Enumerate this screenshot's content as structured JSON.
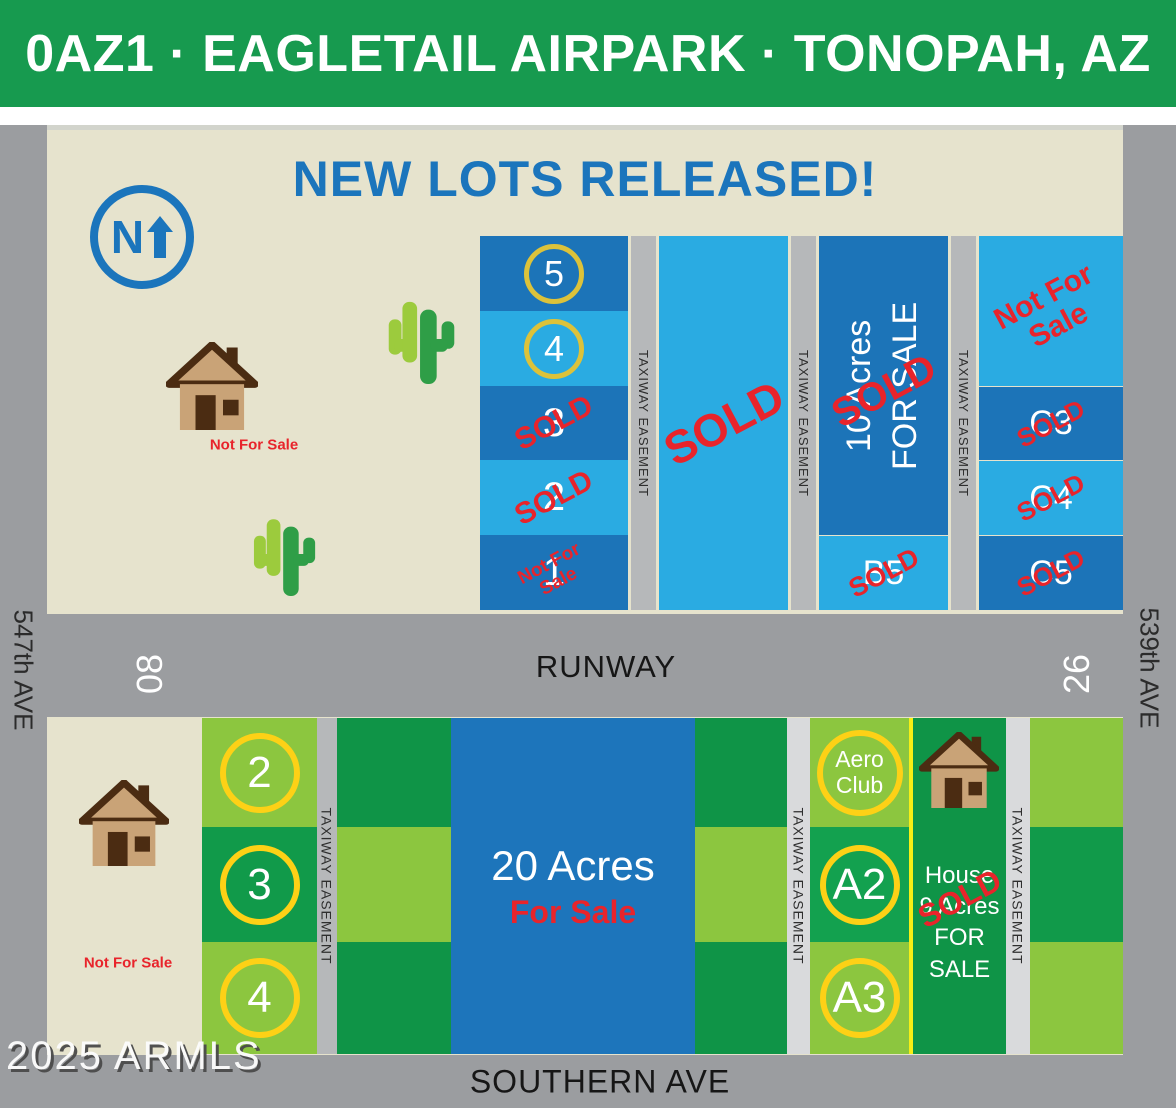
{
  "header": {
    "title": "0AZ1 · EAGLETAIL AIRPARK · TONOPAH, AZ"
  },
  "map": {
    "banner": "NEW LOTS RELEASED!",
    "compass": "N",
    "streets": {
      "left": "547th AVE",
      "right": "539th AVE",
      "bottom": "SOUTHERN AVE"
    },
    "runway": {
      "label": "RUNWAY",
      "west_number": "08",
      "east_number": "26"
    },
    "taxiway_label": "TAXIWAY EASEMENT",
    "stamps": {
      "sold": "SOLD",
      "not_for": "Not For",
      "sale": "Sale"
    },
    "houses": {
      "north_label": "Not For Sale",
      "southwest_label": "Not For Sale"
    },
    "north_lots": {
      "numbered": [
        {
          "label": "5"
        },
        {
          "label": "4"
        },
        {
          "label": "3"
        },
        {
          "label": "2"
        },
        {
          "label": "1"
        }
      ],
      "ten_acres": {
        "line1": "10 Acres",
        "line2": "FOR SALE"
      },
      "b5": {
        "label": "B5"
      },
      "c_block": {
        "lots": [
          {
            "label": "C3"
          },
          {
            "label": "C4"
          },
          {
            "label": "C5"
          }
        ]
      }
    },
    "south_lots": {
      "numbered": [
        {
          "label": "2"
        },
        {
          "label": "3"
        },
        {
          "label": "4"
        }
      ],
      "twenty_acres": {
        "line1": "20 Acres",
        "line2": "For Sale"
      },
      "aero_club": {
        "line1": "Aero",
        "line2": "Club"
      },
      "a_lots": [
        {
          "label": "A2"
        },
        {
          "label": "A3"
        }
      ],
      "house_lot": {
        "line1": "House",
        "line2": "9 Acres",
        "line3": "FOR SALE"
      }
    }
  },
  "watermark": "2025 ARMLS",
  "colors": {
    "header_green": "#179a4f",
    "title_blue": "#1b75bc",
    "beige": "#e6e3cd",
    "lot_dark_blue": "#1c74b8",
    "lot_light_blue": "#2aabe2",
    "lot_dark_green": "#0f9447",
    "lot_mid_green": "#119a4a",
    "lot_light_green": "#8cc63f",
    "road_gray": "#9b9da0",
    "taxiway_gray": "#b6b8ba",
    "taxiway_light_gray": "#d9dadc",
    "sold_red": "#e8242b",
    "ring_yellow": "#fdd116",
    "ring_gold": "#dcc23a",
    "yellow_divider": "#f6ef15",
    "house_tan": "#c9a377",
    "house_brown": "#4b2c12"
  }
}
